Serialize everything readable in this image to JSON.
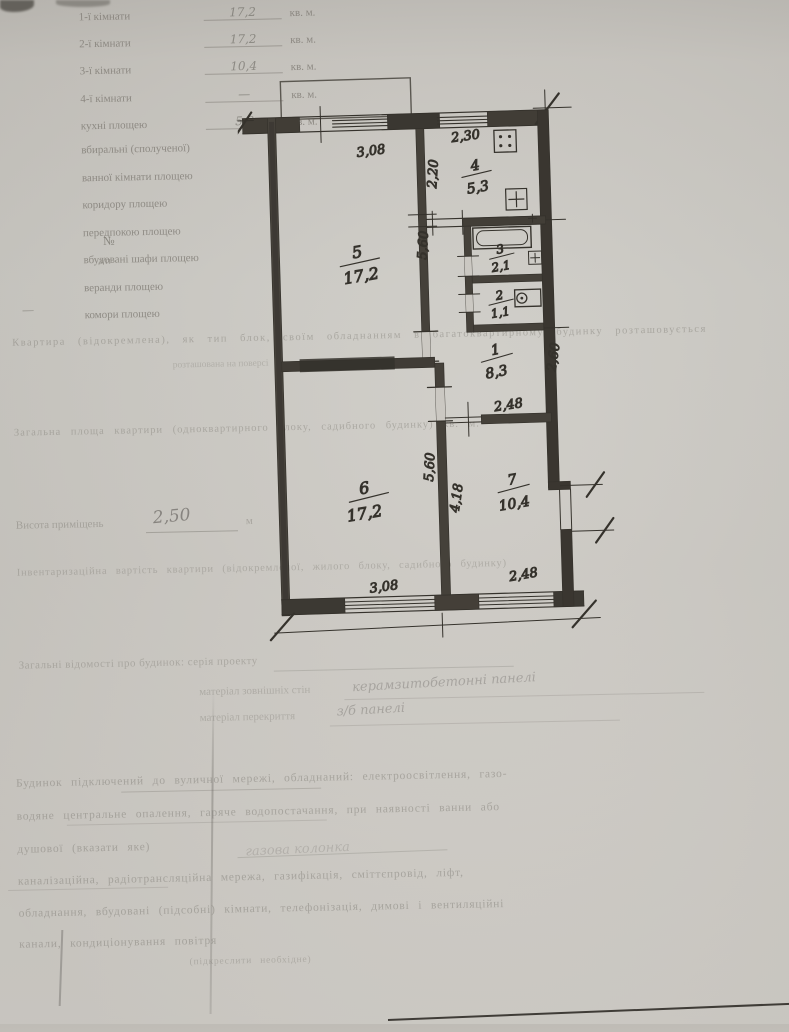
{
  "form": {
    "no_label": "№",
    "no_sub": "з/п",
    "margin_dash": "—",
    "rows": [
      {
        "label": "1-ї кімнати",
        "value": "17,2",
        "unit": "кв. м."
      },
      {
        "label": "2-ї кімнати",
        "value": "17,2",
        "unit": "кв. м."
      },
      {
        "label": "3-ї кімнати",
        "value": "10,4",
        "unit": "кв. м."
      },
      {
        "label": "4-ї кімнати",
        "value": "—",
        "unit": "кв. м."
      },
      {
        "label": "кухні площею",
        "value": "5,3",
        "unit": "кв. м."
      },
      {
        "label": "вбиральні (сполученої)",
        "value": "",
        "unit": ""
      },
      {
        "label": "ванної кімнати площею",
        "value": "",
        "unit": ""
      },
      {
        "label": "коридору площею",
        "value": "",
        "unit": ""
      },
      {
        "label": "передпокою площею",
        "value": "",
        "unit": ""
      },
      {
        "label": "вбудовані шафи площею",
        "value": "",
        "unit": ""
      },
      {
        "label": "веранди площею",
        "value": "",
        "unit": ""
      },
      {
        "label": "комори площею",
        "value": "",
        "unit": ""
      }
    ]
  },
  "plan": {
    "rooms": {
      "r1": {
        "number": "1",
        "area": "8,3"
      },
      "r2": {
        "number": "2",
        "area": "1,1"
      },
      "r3": {
        "number": "3",
        "area": "2,1"
      },
      "r4": {
        "number": "4",
        "area": "5,3"
      },
      "r5": {
        "number": "5",
        "area": "17,2"
      },
      "r6": {
        "number": "6",
        "area": "17,2"
      },
      "r7": {
        "number": "7",
        "area": "10,4"
      }
    },
    "dims": {
      "top": "3,08",
      "kitchen_w": "2,30",
      "kitchen_h": "2,20",
      "room5_h": "5,60",
      "hall_h": "2,60",
      "hall_w": "2,48",
      "room6_h": "5,60",
      "room7_h": "4,18",
      "room7_w": "2,48",
      "room6_w": "3,08"
    }
  },
  "notes": {
    "apartment_line": "Квартира (відокремлена), як тип блок, своїм обладнанням в багатоквартирному будинку розташовується",
    "floor_line": "розташована на поверсі",
    "total_line": "Загальна площа квартири (одноквартирного блоку, садибного будинку)        кв. м.",
    "height_label": "Висота приміщень",
    "height_value": "2,50",
    "height_unit": "м",
    "inventory_line": "Інвентаризаційна вартість квартири (відокремленої, жилого блоку, садибного будинку)",
    "general_line": "Загальні відомості про будинок: серія проекту",
    "walls_label": "матеріал зовнішніх стін",
    "walls_value": "керамзитобетонні панелі",
    "slab_label": "матеріал перекриття",
    "slab_value": "з/б панелі",
    "colonka_scribble": "газова колонка",
    "paragraph": [
      "Будинок підключений до вуличної мережі, обладнаний: електроосвітлення, газо-",
      "водяне центральне опалення, гаряче водопостачання, при наявності ванни або",
      "душової (вказати яке)",
      "каналізаційна, радіотрансляційна мережа, газифікація, сміттєпровід, ліфт,",
      "обладнання, вбудовані (підсобні) кімнати, телефонізація, димові і вентиляційні",
      "канали, кондиціонування повітря",
      "(підкреслити необхідне)"
    ]
  }
}
